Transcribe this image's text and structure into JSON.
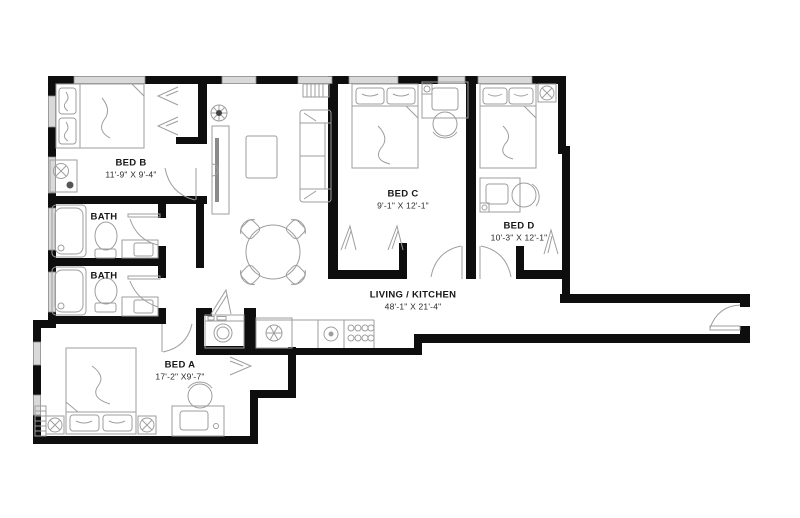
{
  "plan": {
    "type": "apartment-floor-plan",
    "wall_color": "#0e0e0e",
    "furniture_color": "#9e9e9e",
    "window_color": "#d9d9d9",
    "background": "#ffffff",
    "text_color": "#161616"
  },
  "rooms": {
    "bed_b": {
      "name": "BED B",
      "dims": "11'-9\" X 9'-4\"",
      "furniture": [
        "double-bed",
        "closet-hangers",
        "dresser",
        "ceiling-fan",
        "window"
      ]
    },
    "bath_1": {
      "name": "BATH",
      "furniture": [
        "shower",
        "toilet",
        "sink-vanity",
        "door"
      ]
    },
    "bath_2": {
      "name": "BATH",
      "furniture": [
        "shower",
        "toilet",
        "sink-vanity",
        "door"
      ]
    },
    "bed_a": {
      "name": "BED A",
      "dims": "17'-2\" X9'-7\"",
      "furniture": [
        "double-bed",
        "desk",
        "desk-chair",
        "ceiling-fan",
        "radiator",
        "closet-bifold"
      ]
    },
    "living_kitchen": {
      "name": "LIVING / KITCHEN",
      "dims": "48'-1\" X 21'-4\"",
      "furniture": [
        "sofa",
        "tv-console",
        "coffee-table",
        "plant",
        "radiator",
        "dining-table",
        "dining-chairs",
        "washer",
        "refrigerator",
        "kitchen-sink",
        "stove",
        "entry-door"
      ]
    },
    "bed_c": {
      "name": "BED C",
      "dims": "9'-1\" X 12'-1\"",
      "furniture": [
        "double-bed",
        "desk",
        "desk-chair",
        "closet-hangers"
      ]
    },
    "bed_d": {
      "name": "BED D",
      "dims": "10'-3\" X 12'-1\"",
      "furniture": [
        "double-bed",
        "desk",
        "desk-chair",
        "ceiling-fan",
        "closet-hangers"
      ]
    }
  }
}
